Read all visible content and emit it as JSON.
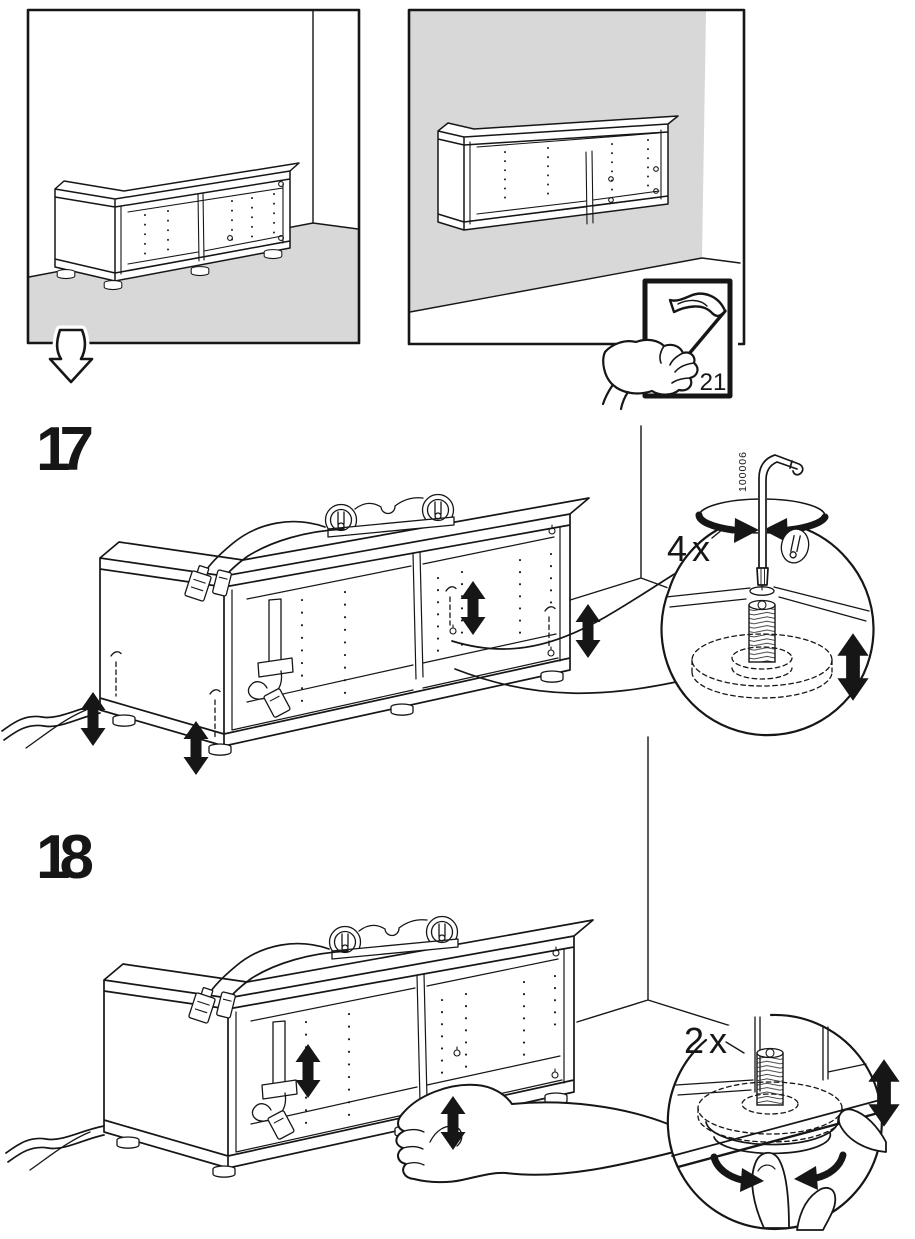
{
  "colors": {
    "background": "#ffffff",
    "line": "#161616",
    "floor_wall_gray": "#d8d8d8"
  },
  "intro_panels": {
    "floor_panel": {
      "content": "cabinet-standing-on-floor"
    },
    "wall_panel": {
      "content": "cabinet-mounted-on-wall",
      "page_flip_number": "21"
    }
  },
  "steps": {
    "step17": {
      "number": "17",
      "quantity": "4x",
      "tool_part_number": "100006"
    },
    "step18": {
      "number": "18",
      "quantity": "2x"
    }
  },
  "icons": {
    "continue_arrow": "hollow-down-arrow",
    "page_flip": "hand-flipping-page-corner",
    "adjust_height": "double-headed-vertical-arrow",
    "rotate_tool": "rotation-ellipse-arrows",
    "turn_foot": "curved-turn-arrows"
  }
}
